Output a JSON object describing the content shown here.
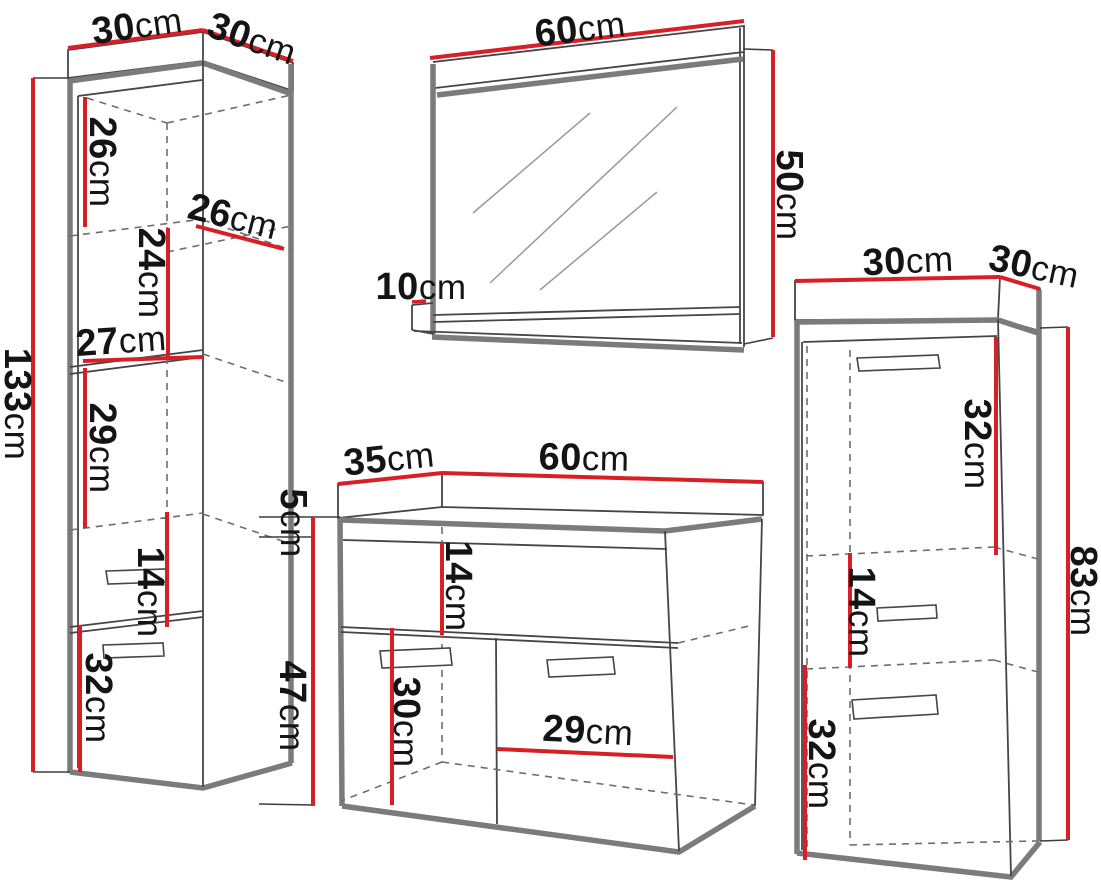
{
  "unit": "cm",
  "colors": {
    "dimension_line": "#d81f26",
    "outline": "#454545",
    "panel_shadow": "#7b7b7b",
    "text": "#141414",
    "background": "#ffffff"
  },
  "items": {
    "tall_cabinet": {
      "dimensions": {
        "width_top": {
          "value": "30",
          "unit": "cm"
        },
        "depth_top": {
          "value": "30",
          "unit": "cm"
        },
        "height_total": {
          "value": "133",
          "unit": "cm"
        },
        "top_shelf_height": {
          "value": "26",
          "unit": "cm"
        },
        "shelf_depth": {
          "value": "26",
          "unit": "cm"
        },
        "second_shelf_height": {
          "value": "24",
          "unit": "cm"
        },
        "inner_width": {
          "value": "27",
          "unit": "cm"
        },
        "third_shelf_height": {
          "value": "29",
          "unit": "cm"
        },
        "drawer_height": {
          "value": "14",
          "unit": "cm"
        },
        "door_height": {
          "value": "32",
          "unit": "cm"
        }
      }
    },
    "mirror": {
      "dimensions": {
        "width": {
          "value": "60",
          "unit": "cm"
        },
        "height": {
          "value": "50",
          "unit": "cm"
        },
        "shelf_depth": {
          "value": "10",
          "unit": "cm"
        }
      }
    },
    "side_cabinet": {
      "dimensions": {
        "width_top": {
          "value": "30",
          "unit": "cm"
        },
        "depth_top": {
          "value": "30",
          "unit": "cm"
        },
        "top_door_height": {
          "value": "32",
          "unit": "cm"
        },
        "drawer_height": {
          "value": "14",
          "unit": "cm"
        },
        "bottom_door_height": {
          "value": "32",
          "unit": "cm"
        },
        "height_total": {
          "value": "83",
          "unit": "cm"
        }
      }
    },
    "vanity_cabinet": {
      "dimensions": {
        "depth_top": {
          "value": "35",
          "unit": "cm"
        },
        "width_top": {
          "value": "60",
          "unit": "cm"
        },
        "countertop_height": {
          "value": "5",
          "unit": "cm"
        },
        "body_height": {
          "value": "47",
          "unit": "cm"
        },
        "drawer_height": {
          "value": "14",
          "unit": "cm"
        },
        "door_height": {
          "value": "30",
          "unit": "cm"
        },
        "inner_width": {
          "value": "29",
          "unit": "cm"
        }
      }
    }
  }
}
